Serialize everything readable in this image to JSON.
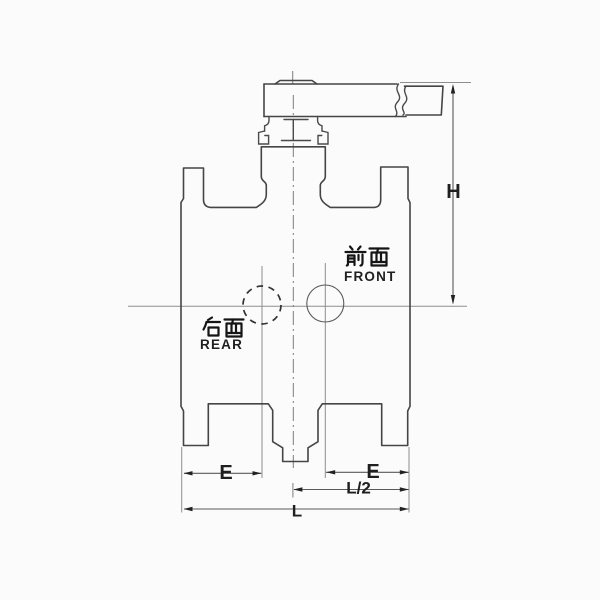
{
  "drawing": {
    "title": "ball-valve-front-view-technical-drawing",
    "front_label_cn": "前面",
    "front_label_en": "FRONT",
    "rear_label_cn": "后面",
    "rear_label_en": "REAR"
  },
  "dims": {
    "h": "H",
    "e_left": "E",
    "e_right": "E",
    "l_half": "L/2",
    "l": "L"
  },
  "colors": {
    "background": "#fbfbfb",
    "outline": "#454545",
    "thin_line": "#8e8e8e",
    "centerline": "#7d7d7d",
    "text": "#1f1f1f"
  }
}
